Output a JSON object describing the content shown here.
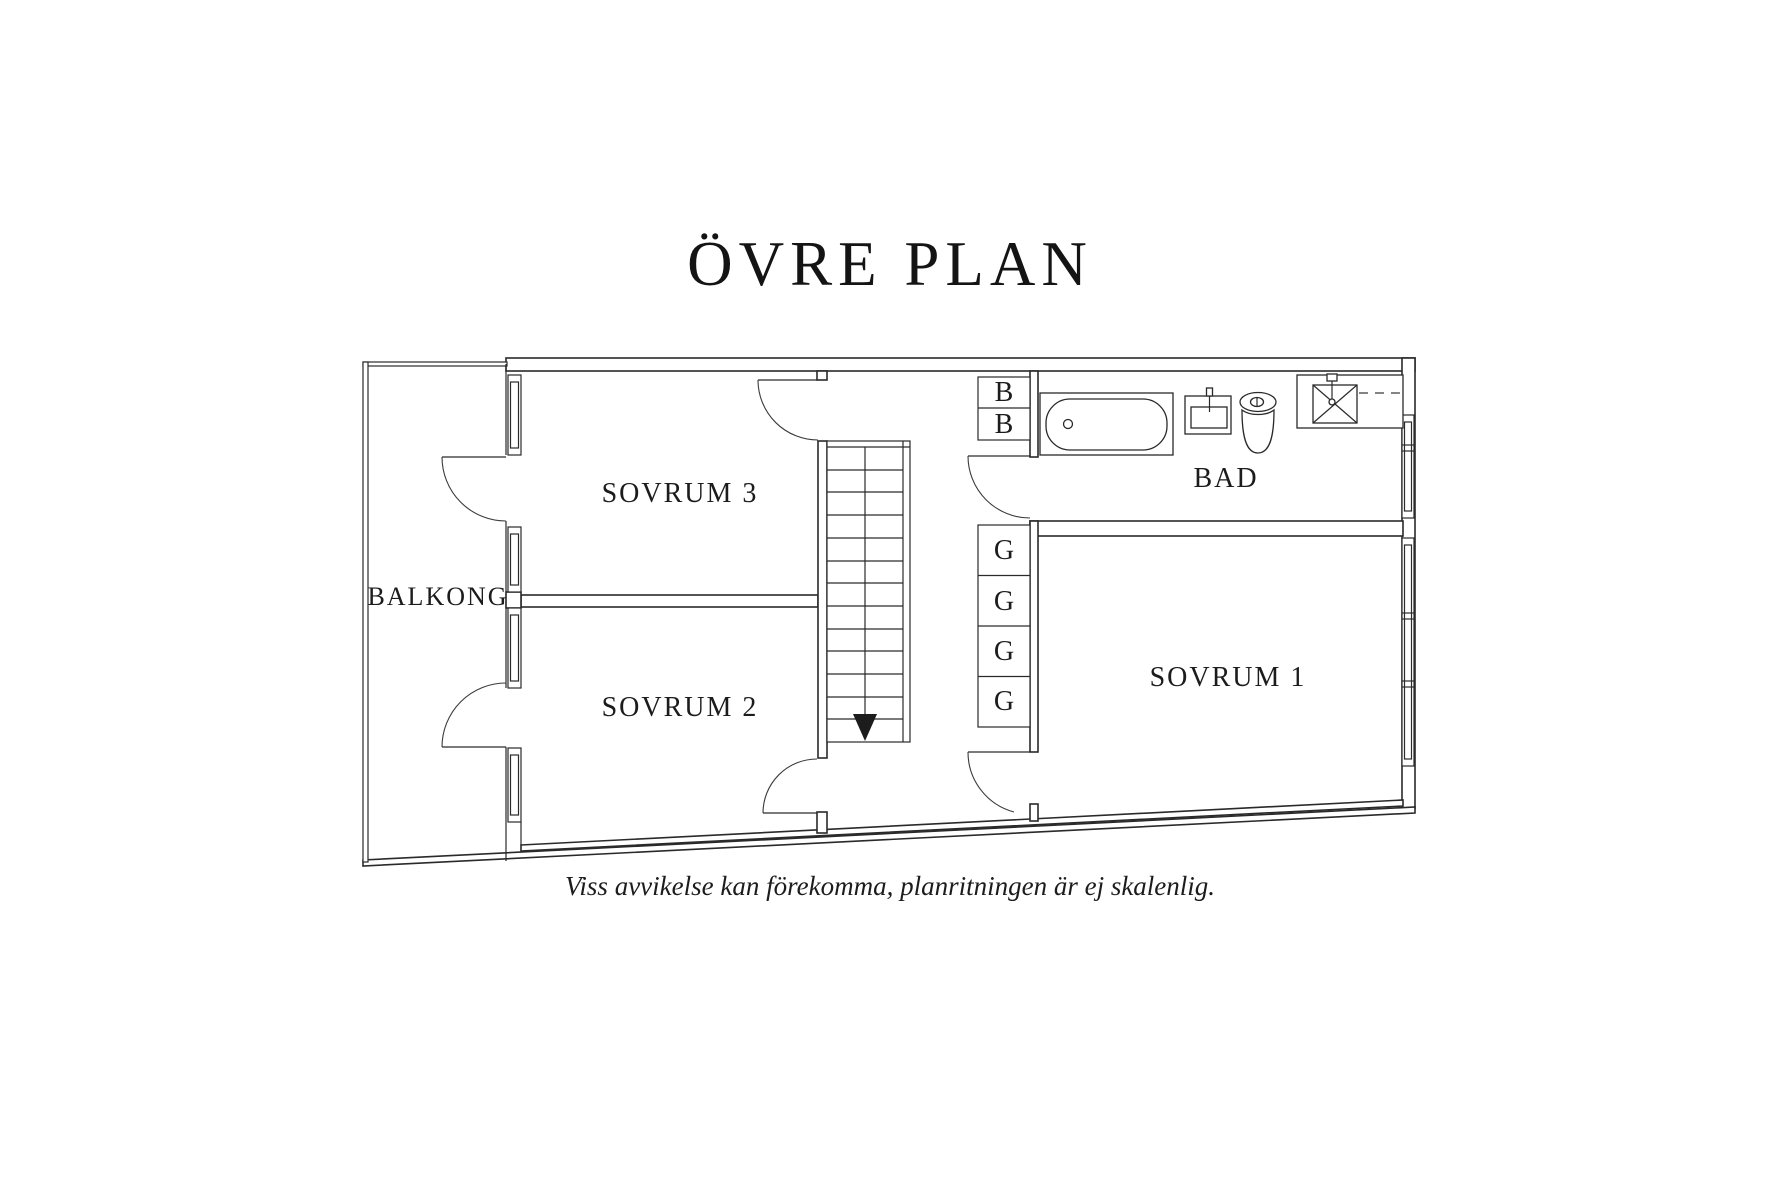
{
  "title": "ÖVRE PLAN",
  "plan": {
    "rooms": {
      "balkong": {
        "label": "BALKONG"
      },
      "sovrum3": {
        "label": "SOVRUM 3"
      },
      "sovrum2": {
        "label": "SOVRUM 2"
      },
      "sovrum1": {
        "label": "SOVRUM 1"
      },
      "bad": {
        "label": "BAD"
      }
    },
    "closets": {
      "b": [
        "B",
        "B"
      ],
      "g": [
        "G",
        "G",
        "G",
        "G"
      ]
    }
  },
  "footer": {
    "disclaimer": "Viss avvikelse kan förekomma, planritningen är ej skalenlig."
  },
  "colors": {
    "line": "#2a2a2a",
    "text": "#1c1c1c",
    "background": "#ffffff"
  }
}
